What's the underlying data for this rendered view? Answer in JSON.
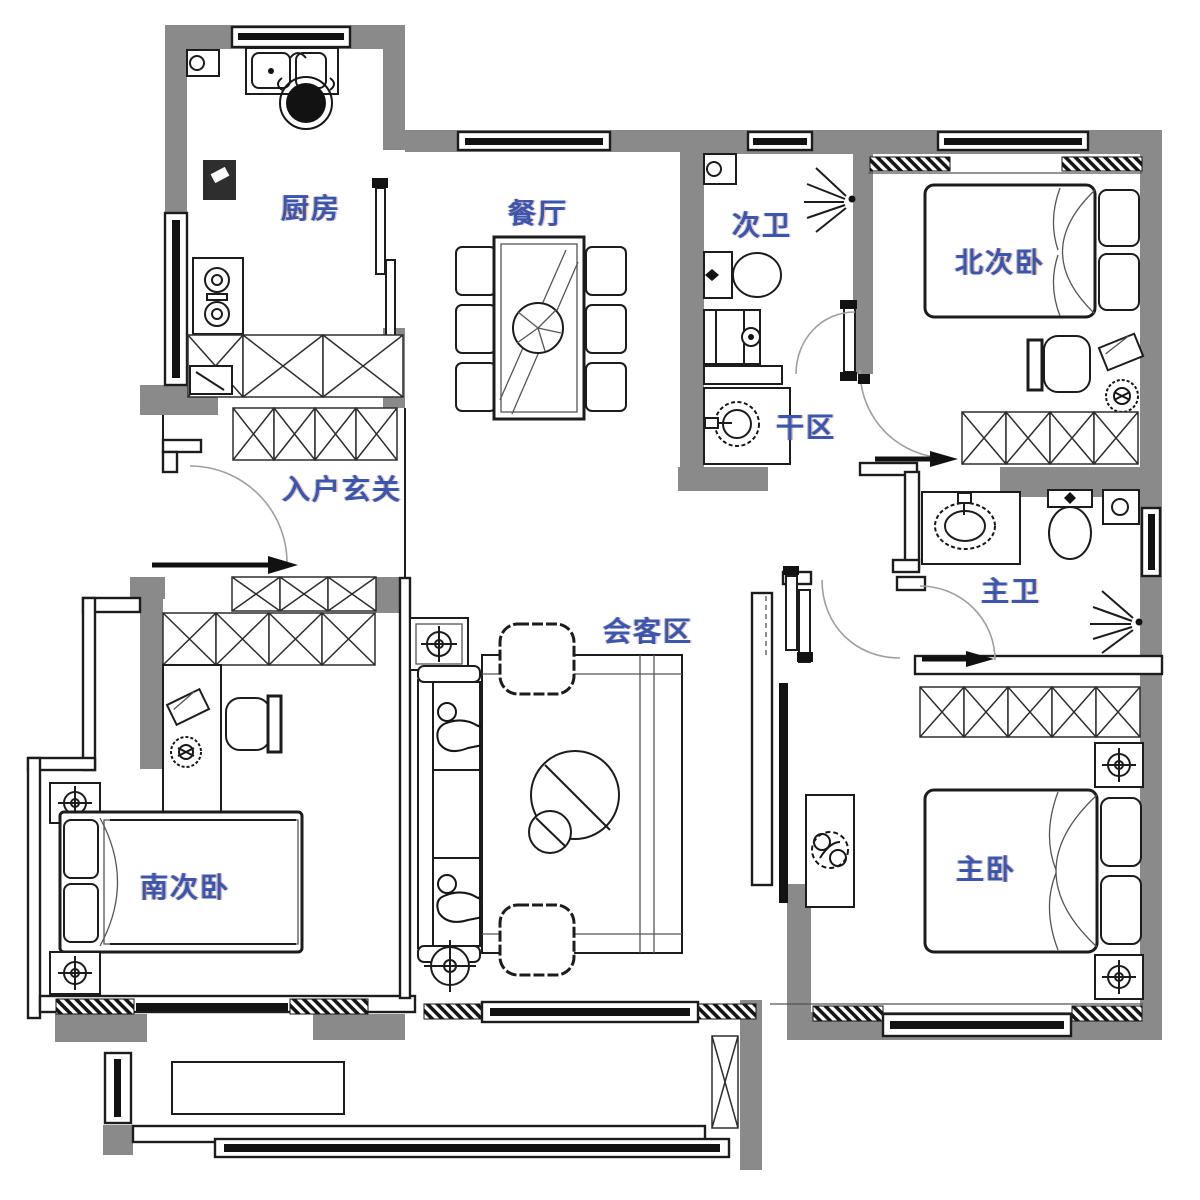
{
  "plan": {
    "type": "apartment-floor-plan",
    "colors": {
      "wall": "#8a8a8a",
      "line": "#1c1c1c",
      "label": "#3c55ad"
    },
    "rooms": [
      {
        "id": "kitchen",
        "label": "厨房"
      },
      {
        "id": "dining",
        "label": "餐厅"
      },
      {
        "id": "bath-second",
        "label": "次卫"
      },
      {
        "id": "bedroom-north",
        "label": "北次卧"
      },
      {
        "id": "dry-area",
        "label": "干区"
      },
      {
        "id": "entry-foyer",
        "label": "入户玄关"
      },
      {
        "id": "living-area",
        "label": "会客区"
      },
      {
        "id": "bath-master",
        "label": "主卫"
      },
      {
        "id": "bedroom-south",
        "label": "南次卧"
      },
      {
        "id": "bedroom-master",
        "label": "主卧"
      }
    ],
    "furniture_symbols": [
      "kitchen-sink",
      "stove",
      "fridge",
      "cutting-board",
      "dining-table",
      "dining-chairs",
      "toilet",
      "washing-machine",
      "wash-basin",
      "shower-spray",
      "double-bed",
      "single-bed",
      "wardrobe",
      "desk",
      "desk-chair",
      "potted-plant",
      "rug",
      "sofa",
      "coffee-table",
      "floor-cushion",
      "floor-lamp",
      "table-lamp",
      "tv-panel",
      "balcony-cabinet",
      "sliding-window",
      "door-swing-arc",
      "entry-arrow"
    ]
  }
}
